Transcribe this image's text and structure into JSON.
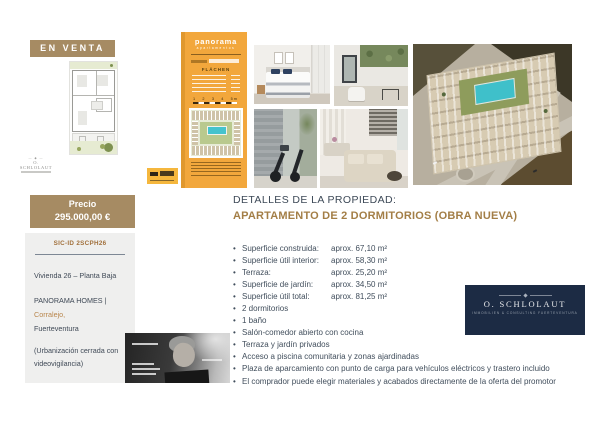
{
  "badge": {
    "label": "EN VENTA"
  },
  "price": {
    "label": "Precio",
    "value": "295.000,00 €"
  },
  "listing": {
    "sic_id": "SIC-ID 2SCPH26",
    "unit": "Vivienda 26 – Planta Baja",
    "development": "PANORAMA HOMES ",
    "separator": "| ",
    "location_highlight": "Corralejo,",
    "location": "Fuerteventura",
    "note_line1": "(Urbanización cerrada con",
    "note_line2": "videovigilancia)"
  },
  "brochure": {
    "brand": "panorama",
    "brand_sub": "apartamentos",
    "section_title": "FLÄCHEN",
    "scale_numbers": [
      "1",
      "2",
      "3",
      "4",
      "5 m"
    ]
  },
  "details": {
    "heading": "DETALLES DE LA PROPIEDAD:",
    "subheading": "APARTAMENTO DE 2 DORMITORIOS (OBRA NUEVA)",
    "bullet_char": "•",
    "specs": [
      {
        "label": "Superficie construida:",
        "value": "aprox. 67,10 m²"
      },
      {
        "label": "Superficie útil interior:",
        "value": "aprox. 58,30 m²"
      },
      {
        "label": "Terraza:",
        "value": "aprox. 25,20 m²"
      },
      {
        "label": "Superficie de jardín:",
        "value": "aprox. 34,50 m²"
      },
      {
        "label": "Superficie útil total:",
        "value": "aprox. 81,25 m²"
      }
    ],
    "features": [
      "2 dormitorios",
      "1 baño",
      "Salón-comedor abierto con cocina",
      "Terraza y jardín privados",
      "Acceso a piscina comunitaria y zonas ajardinadas",
      "Plaza de aparcamiento con punto de carga para vehículos eléctricos y trastero incluido",
      "El comprador puede elegir materiales y acabados directamente de la oferta del promotor"
    ]
  },
  "agency": {
    "name": "O. SCHLOLAUT",
    "tagline": "IMMOBILIEN & CONSULTING FUERTEVENTURA"
  }
}
